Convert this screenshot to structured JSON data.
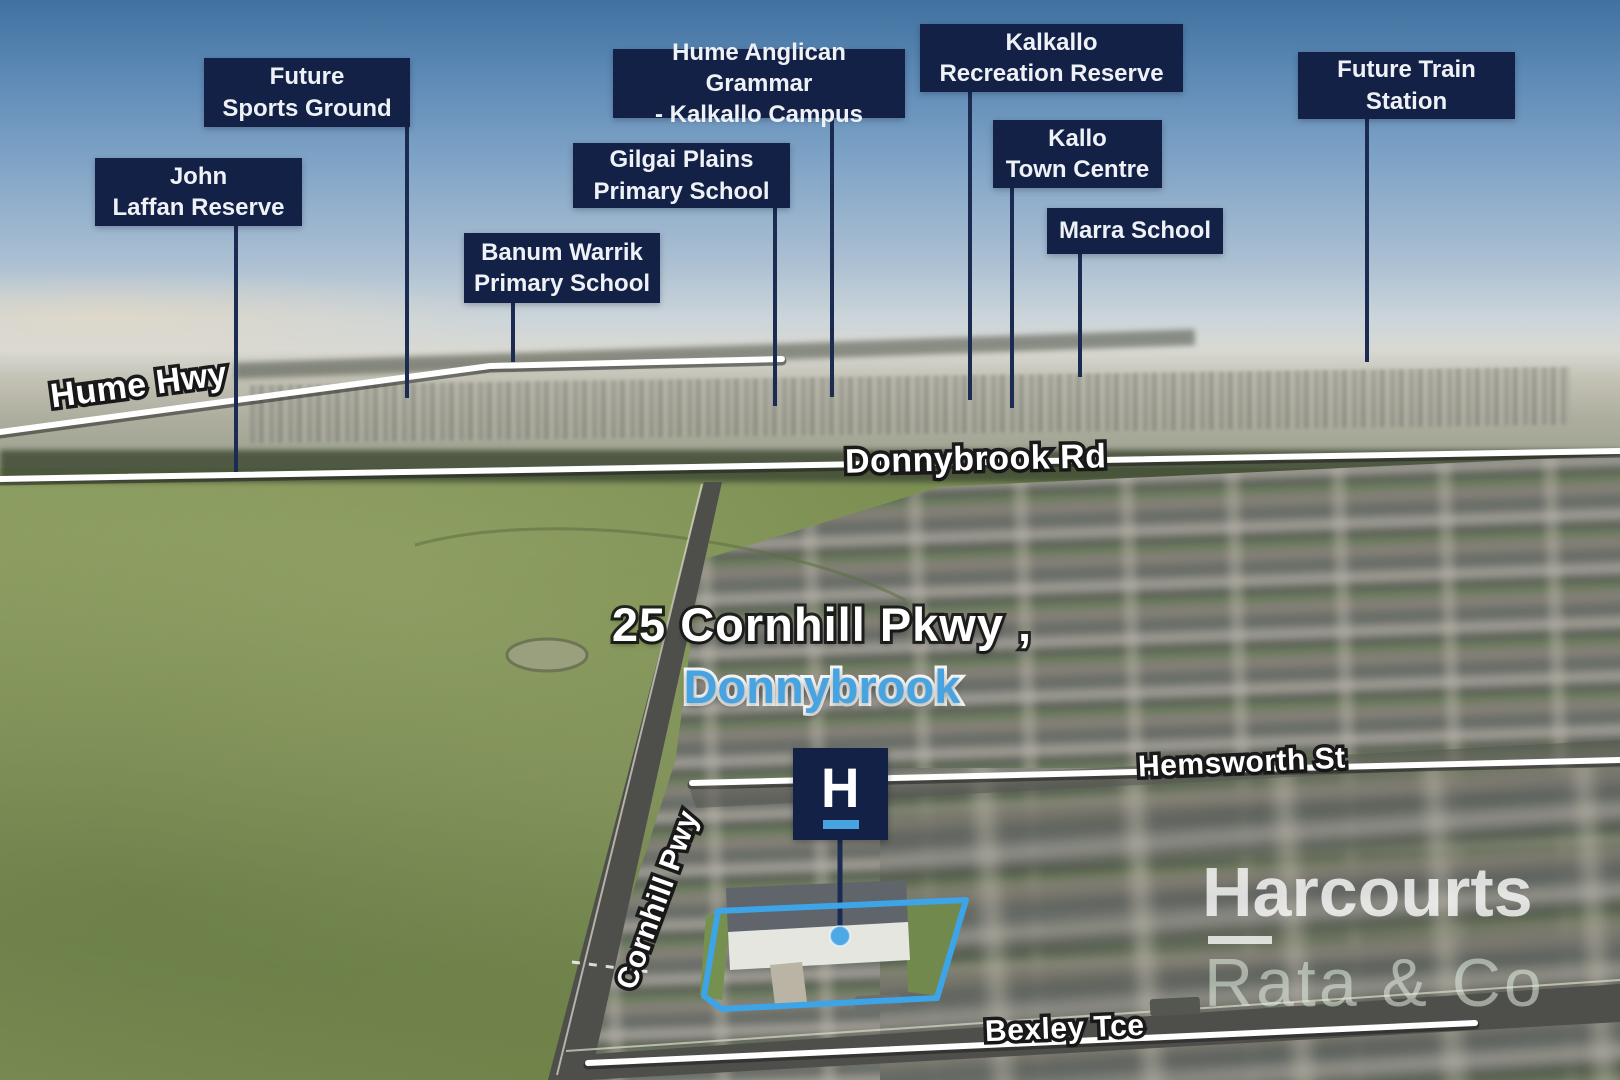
{
  "colors": {
    "label-bg": "#142146",
    "label-text": "#eef2f6",
    "accent-blue": "#47a4e1",
    "line-navy": "#1c2b52",
    "outline-blue": "#3da4e8",
    "road-line": "#ffffff"
  },
  "location_labels": {
    "future_sports_ground": {
      "text": "Future\nSports Ground"
    },
    "john_laffan_reserve": {
      "text": "John\nLaffan Reserve"
    },
    "hume_anglican_grammar": {
      "text": "Hume Anglican Grammar\n- Kalkallo Campus"
    },
    "gilgai_plains_primary": {
      "text": "Gilgai Plains\nPrimary School"
    },
    "banum_warrik_primary": {
      "text": "Banum Warrik\nPrimary School"
    },
    "kalkallo_recreation_reserve": {
      "text": "Kalkallo\nRecreation Reserve"
    },
    "kallo_town_centre": {
      "text": "Kallo\nTown Centre"
    },
    "marra_school": {
      "text": "Marra School"
    },
    "future_train_station": {
      "text": "Future Train\nStation"
    }
  },
  "road_labels": {
    "hume_hwy": "Hume Hwy",
    "donnybrook_rd": "Donnybrook Rd",
    "hemsworth_st": "Hemsworth St",
    "cornhill_pwy": "Cornhill Pwy",
    "bexley_tce": "Bexley Tce"
  },
  "property": {
    "address_line1": "25 Cornhill Pkwy ,",
    "address_line2": "Donnybrook"
  },
  "branding": {
    "logo_letter": "H",
    "agency_name": "Harcourts",
    "office_name": "Rata & Co"
  }
}
